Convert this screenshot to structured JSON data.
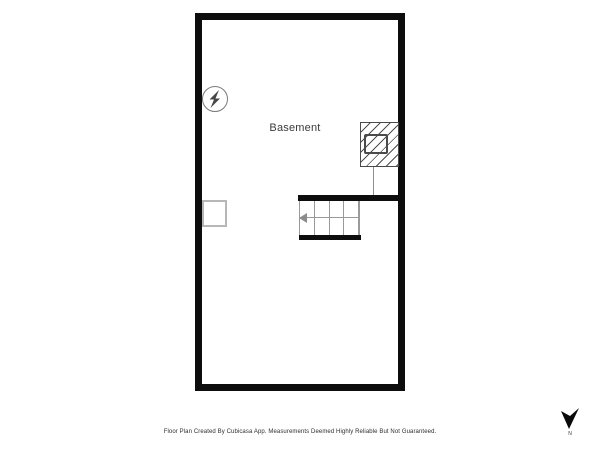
{
  "floorplan": {
    "room_label": "Basement",
    "wall_color": "#0d0d0d",
    "detail_line_color": "#9a9a9a",
    "symbols": {
      "electrical_icon": "circle-lightning-bolt",
      "fireplace_icon": "hatched-rectangle-with-inner-box",
      "appliance_icon": "open-rectangle",
      "stair_tread_count": 4,
      "stair_arrow_direction": "left"
    }
  },
  "footer": {
    "disclaimer": "Floor Plan Created By Cubicasa App. Measurements Deemed Highly Reliable But Not Guaranteed."
  },
  "compass": {
    "north_label": "N"
  }
}
